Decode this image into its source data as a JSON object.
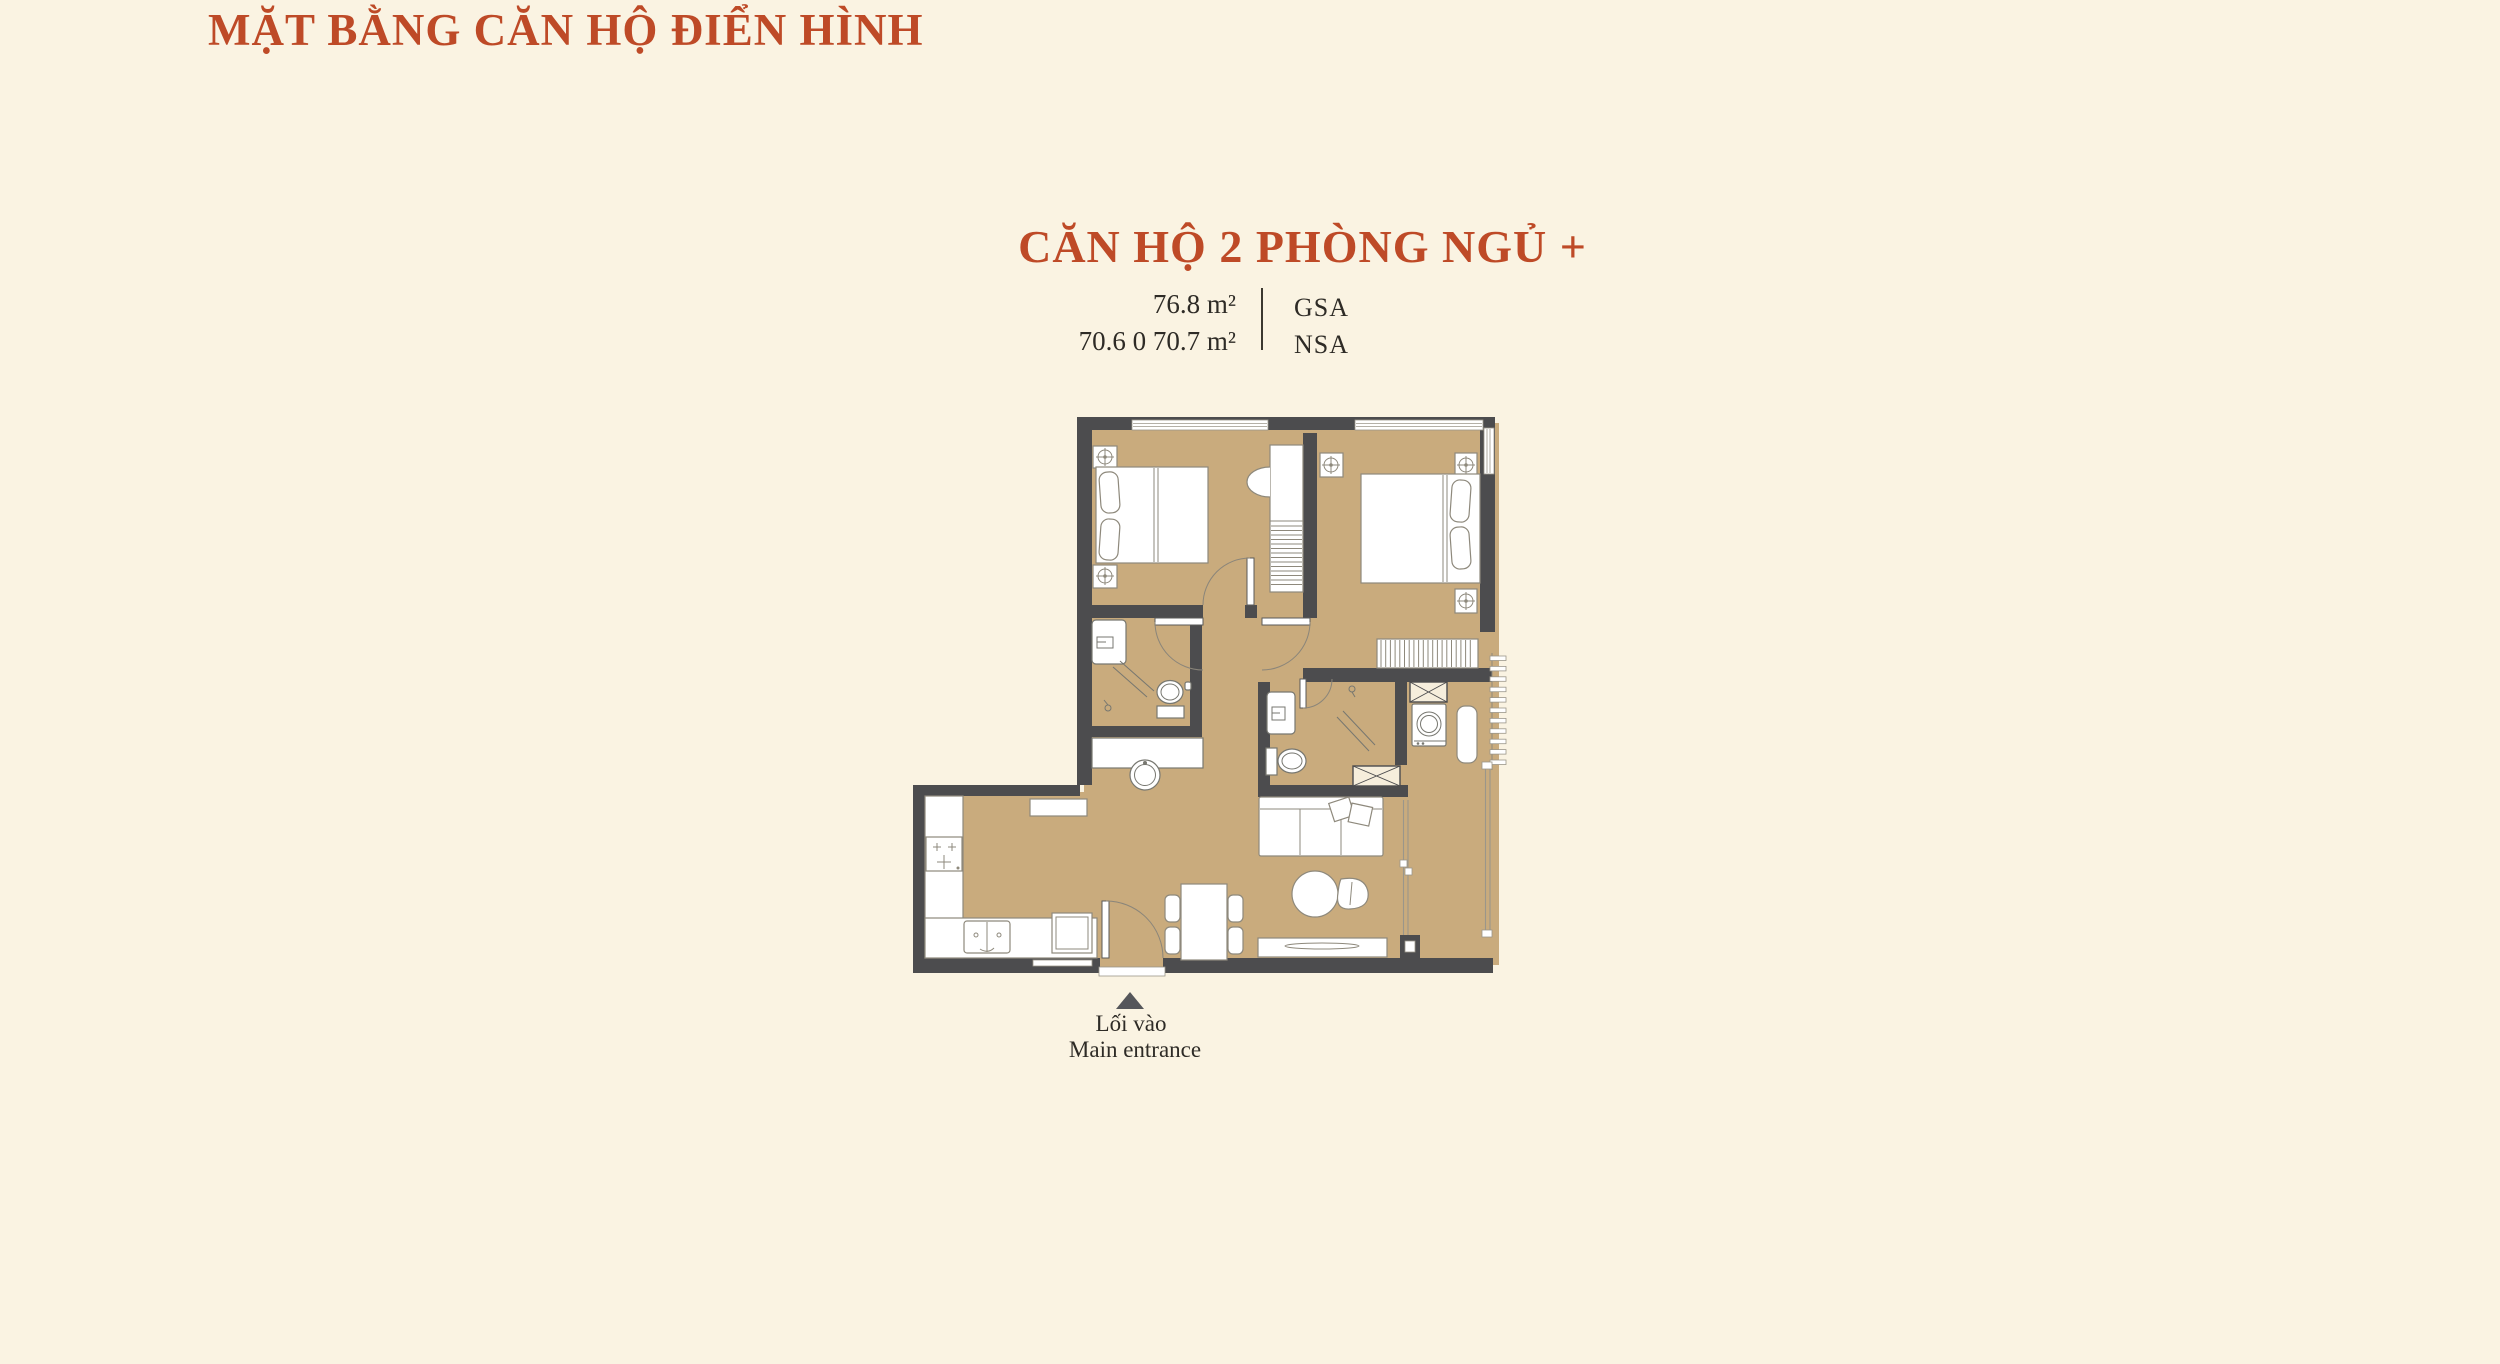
{
  "page": {
    "title": "MẶT BẰNG CĂN HỘ ĐIỂN HÌNH"
  },
  "unit": {
    "name": "CĂN HỘ 2 PHÒNG NGỦ +",
    "areas": [
      {
        "value": "76.8 m²",
        "label": "GSA"
      },
      {
        "value": "70.6 0 70.7 m²",
        "label": "NSA"
      }
    ]
  },
  "entrance": {
    "label_vi": "Lối vào",
    "label_en": "Main entrance"
  },
  "colors": {
    "background": "#FAF3E2",
    "accent": "#BE4A27",
    "text": "#2E2B26",
    "wall": "#4C4C4E",
    "floor": "#C9AB7D",
    "marker": "#55565A"
  }
}
